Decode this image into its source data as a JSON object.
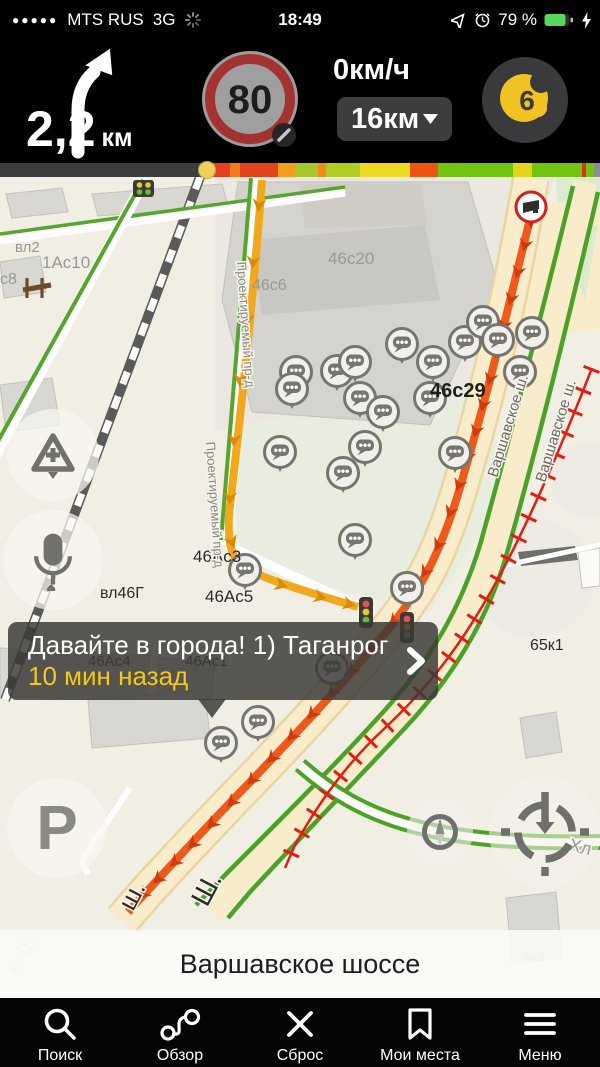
{
  "status_bar": {
    "signal_dots": "●●●●●",
    "carrier": "MTS RUS",
    "network": "3G",
    "time": "18:49",
    "battery_percent": "79 %"
  },
  "nav_panel": {
    "distance_value": "2,2",
    "distance_unit": "км",
    "speed_limit": "80",
    "current_speed": "0км/ч",
    "route_distance": "16км",
    "traffic_score": "6"
  },
  "route_progress": {
    "marker_x": 198,
    "segments": [
      {
        "x": 0,
        "w": 203,
        "color": "#3e3e40"
      },
      {
        "x": 203,
        "w": 27,
        "color": "#e2431c"
      },
      {
        "x": 230,
        "w": 10,
        "color": "#ef7d1e"
      },
      {
        "x": 240,
        "w": 38,
        "color": "#e2431c"
      },
      {
        "x": 278,
        "w": 17,
        "color": "#f09c1e"
      },
      {
        "x": 295,
        "w": 23,
        "color": "#a6c62e"
      },
      {
        "x": 318,
        "w": 8,
        "color": "#ef8c1e"
      },
      {
        "x": 326,
        "w": 34,
        "color": "#b2cc26"
      },
      {
        "x": 360,
        "w": 50,
        "color": "#ecd922"
      },
      {
        "x": 410,
        "w": 28,
        "color": "#ee5512"
      },
      {
        "x": 438,
        "w": 75,
        "color": "#72c312"
      },
      {
        "x": 513,
        "w": 19,
        "color": "#e4d41e"
      },
      {
        "x": 532,
        "w": 50,
        "color": "#72c312"
      },
      {
        "x": 582,
        "w": 4,
        "color": "#e83010"
      },
      {
        "x": 586,
        "w": 8,
        "color": "#72c312"
      },
      {
        "x": 594,
        "w": 6,
        "color": "#8e8e8c"
      }
    ]
  },
  "map": {
    "labels": [
      {
        "text": "вл2"
      },
      {
        "text": "1Ас10"
      },
      {
        "text": "с8"
      },
      {
        "text": "46с6"
      },
      {
        "text": "46с20"
      },
      {
        "text": "46с29"
      },
      {
        "text": "46Ас3"
      },
      {
        "text": "46Ас5"
      },
      {
        "text": "вл46Г"
      },
      {
        "text": "46Ас4"
      },
      {
        "text": "46Ас1"
      },
      {
        "text": "65к1"
      },
      {
        "text": "4к3"
      },
      {
        "text": "Варшавское ш."
      },
      {
        "text": "Варшавское ш."
      },
      {
        "text": "Проектируемый пр-д"
      },
      {
        "text": "Проектируемый пр-д"
      },
      {
        "text": "ш."
      },
      {
        "text": "Ш."
      },
      {
        "text": "Хл"
      },
      {
        "text": "е ш."
      }
    ],
    "popup": {
      "line1": "Давайте в города! 1) Таганрог",
      "line2": "10 мин назад"
    },
    "street_banner": "Варшавское шоссе",
    "controls": {
      "parking_label": "P"
    }
  },
  "toolbar": {
    "items": [
      {
        "label": "Поиск"
      },
      {
        "label": "Обзор"
      },
      {
        "label": "Сброс"
      },
      {
        "label": "Мои места"
      },
      {
        "label": "Меню"
      }
    ]
  },
  "icons": {
    "toolbar": [
      "search-icon",
      "route-overview-icon",
      "close-icon",
      "bookmark-icon",
      "menu-icon"
    ],
    "map": [
      "chat-bubble-marker",
      "speed-camera-marker",
      "traffic-light-icon",
      "parking-icon",
      "microphone-icon",
      "add-road-event-icon",
      "compass-icon",
      "locate-me-icon"
    ]
  }
}
